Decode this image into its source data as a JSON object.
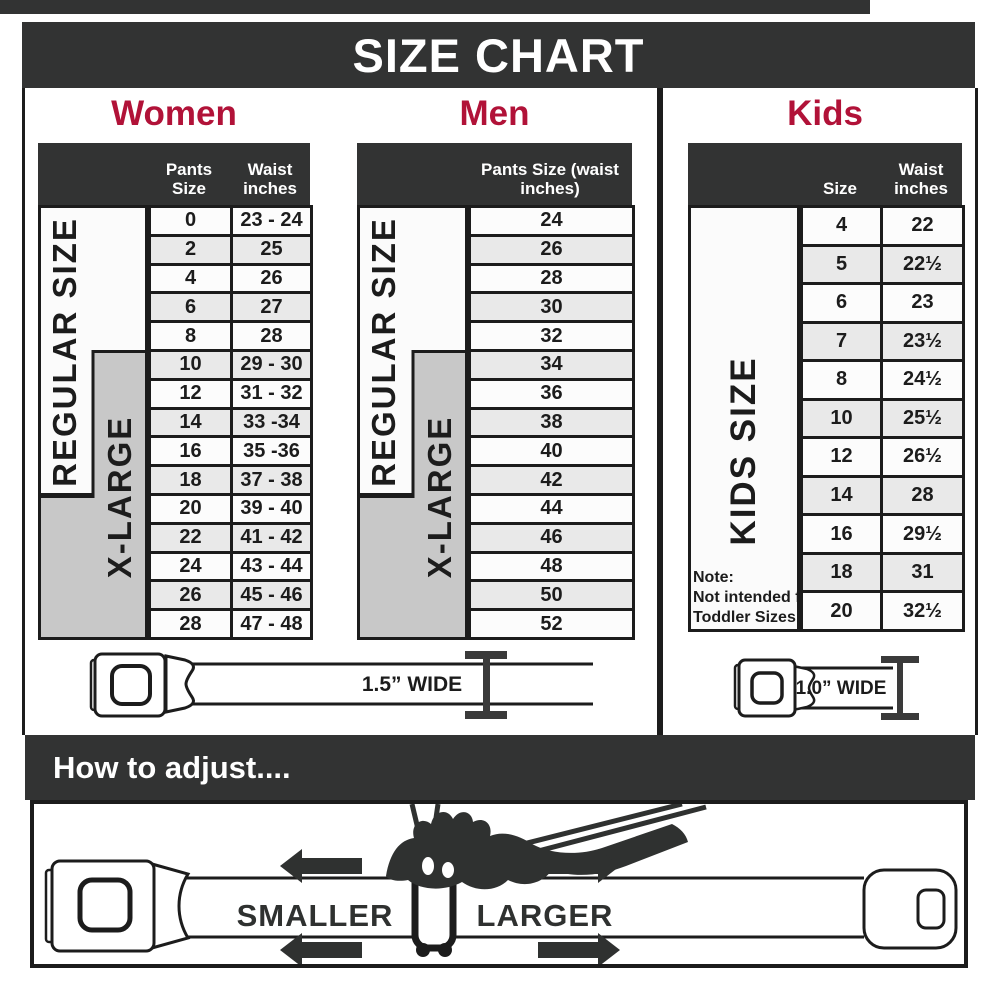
{
  "page": {
    "title": "SIZE CHART"
  },
  "colors": {
    "dark_bar": "#323333",
    "accent_red": "#b11238",
    "line_black": "#1c1c1c",
    "row_white": "#fcfcfc",
    "row_alt": "#e9e9e9",
    "gray_label": "#c8c8c8"
  },
  "columns": {
    "women": {
      "heading": "Women",
      "size_header": "Pants Size",
      "waist_header": "Waist inches",
      "regular_label": "REGULAR SIZE",
      "xlarge_label": "X-LARGE",
      "rows": [
        {
          "size": "0",
          "waist": "23 - 24"
        },
        {
          "size": "2",
          "waist": "25"
        },
        {
          "size": "4",
          "waist": "26"
        },
        {
          "size": "6",
          "waist": "27"
        },
        {
          "size": "8",
          "waist": "28"
        },
        {
          "size": "10",
          "waist": "29 - 30"
        },
        {
          "size": "12",
          "waist": "31 - 32"
        },
        {
          "size": "14",
          "waist": "33 -34"
        },
        {
          "size": "16",
          "waist": "35 -36"
        },
        {
          "size": "18",
          "waist": "37 - 38"
        },
        {
          "size": "20",
          "waist": "39 - 40"
        },
        {
          "size": "22",
          "waist": "41 - 42"
        },
        {
          "size": "24",
          "waist": "43 - 44"
        },
        {
          "size": "26",
          "waist": "45 - 46"
        },
        {
          "size": "28",
          "waist": "47 - 48"
        }
      ]
    },
    "men": {
      "heading": "Men",
      "size_header": "Pants Size (waist inches)",
      "regular_label": "REGULAR SIZE",
      "xlarge_label": "X-LARGE",
      "rows": [
        "24",
        "26",
        "28",
        "30",
        "32",
        "34",
        "36",
        "38",
        "40",
        "42",
        "44",
        "46",
        "48",
        "50",
        "52"
      ]
    },
    "kids": {
      "heading": "Kids",
      "size_header": "Size",
      "waist_header": "Waist inches",
      "side_label": "KIDS SIZE",
      "note_lines": [
        "Note:",
        "Not intended for",
        "Toddler Sizes (T)"
      ],
      "rows": [
        {
          "size": "4",
          "waist": "22"
        },
        {
          "size": "5",
          "waist": "22½"
        },
        {
          "size": "6",
          "waist": "23"
        },
        {
          "size": "7",
          "waist": "23½"
        },
        {
          "size": "8",
          "waist": "24½"
        },
        {
          "size": "10",
          "waist": "25½"
        },
        {
          "size": "12",
          "waist": "26½"
        },
        {
          "size": "14",
          "waist": "28"
        },
        {
          "size": "16",
          "waist": "29½"
        },
        {
          "size": "18",
          "waist": "31"
        },
        {
          "size": "20",
          "waist": "32½"
        }
      ]
    }
  },
  "belts": {
    "adult_label": "1.5” WIDE",
    "kids_label": "1.0” WIDE"
  },
  "adjust": {
    "heading": "How to adjust....",
    "smaller": "SMALLER",
    "larger": "LARGER"
  }
}
